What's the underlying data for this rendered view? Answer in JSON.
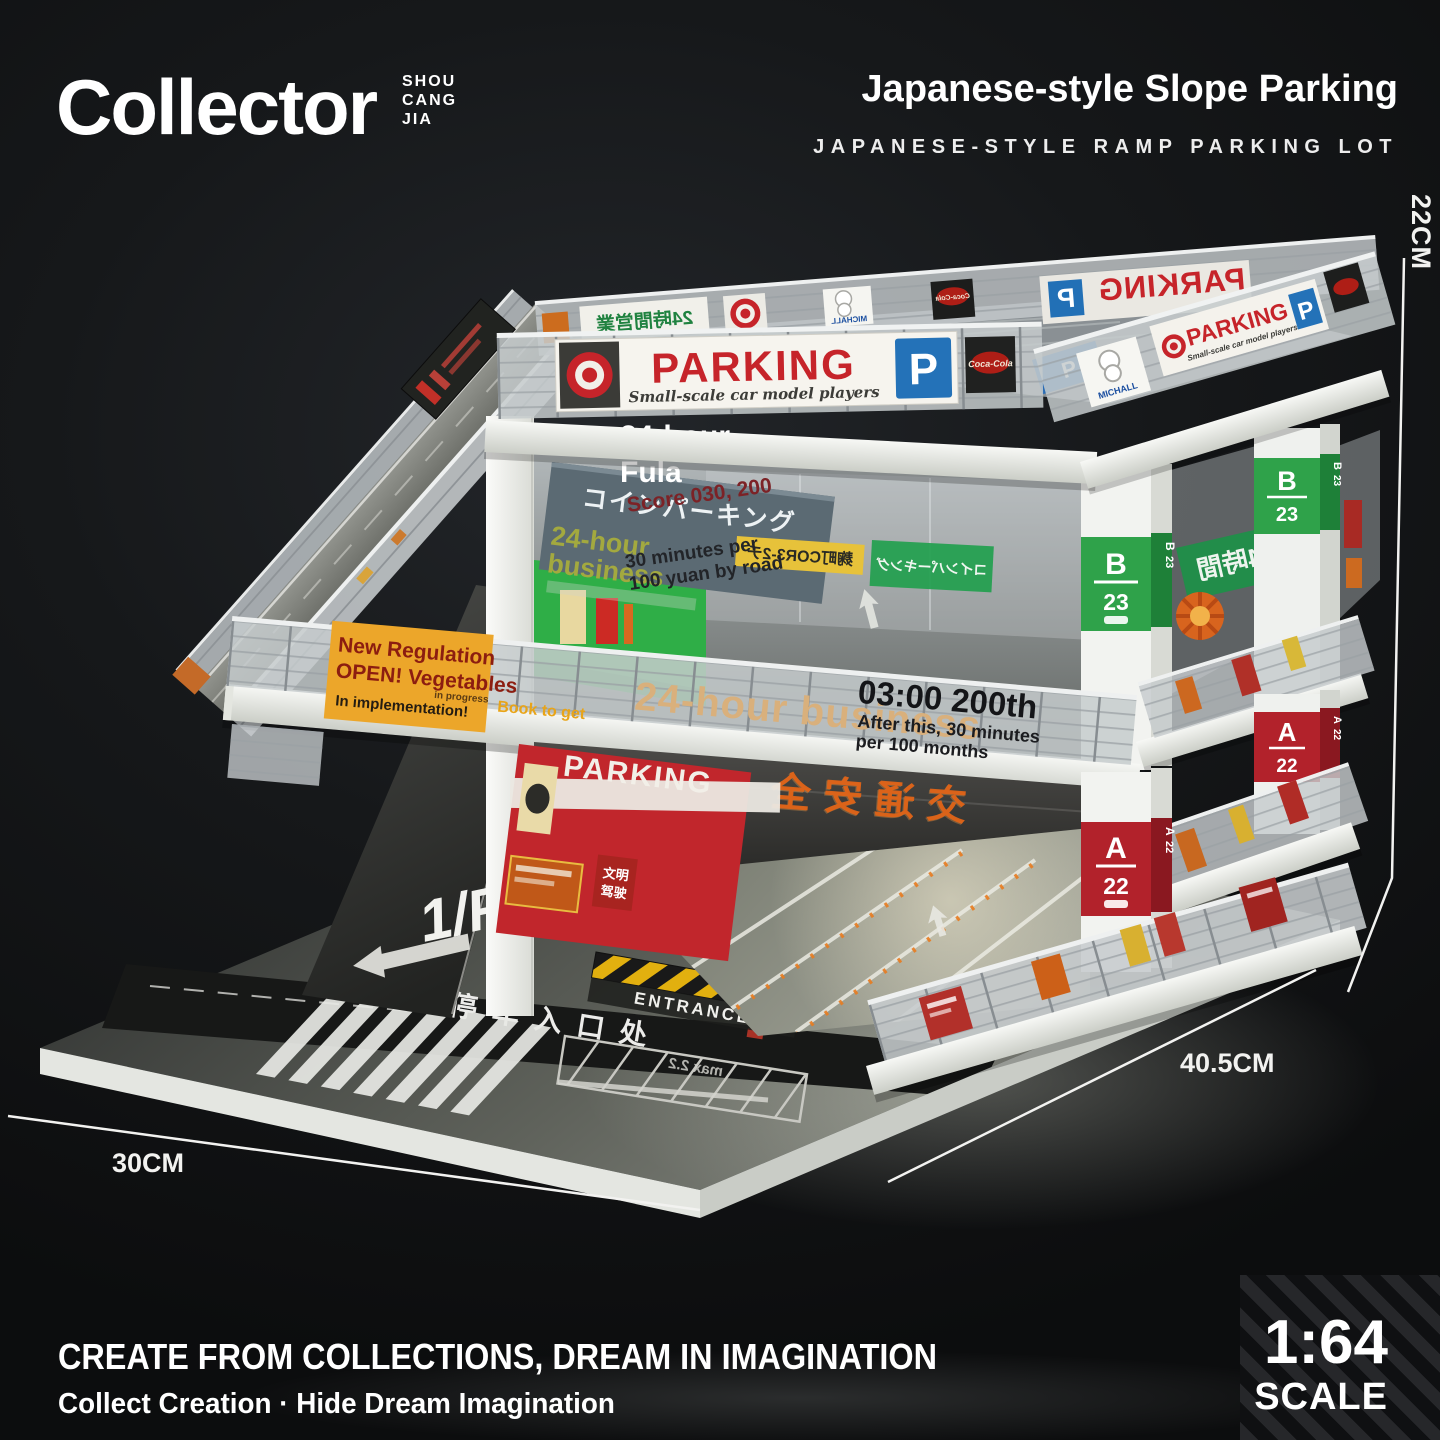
{
  "header": {
    "brand": "Collector",
    "brand_sub_lines": [
      "SHOU",
      "CANG",
      "JIA"
    ],
    "title": "Japanese-style Slope Parking",
    "subtitle": "JAPANESE-STYLE RAMP PARKING LOT"
  },
  "dimensions": {
    "height": "22CM",
    "width": "30CM",
    "depth": "40.5CM"
  },
  "footer": {
    "tagline_en": "CREATE FROM COLLECTIONS, DREAM IN IMAGINATION",
    "tagline_sub": "Collect Creation · Hide Dream Imagination",
    "scale_ratio": "1:64",
    "scale_label": "SCALE"
  },
  "model": {
    "roof": {
      "parking_sign": {
        "title": "PARKING",
        "subtitle": "Small-scale car model players",
        "p": "P"
      },
      "jp_24h_sign": "24時間営業",
      "michelin_label": "MICHALL",
      "cola_label": "Coca-Cola",
      "bay_p": "P"
    },
    "floor2": {
      "coin_parking_jp": "コインパーキング",
      "business_line1": "24-hour",
      "business_line2": "business",
      "overlay_line1": "24-hour",
      "overlay_line2": "Fula",
      "overlay_score": "Score 030, 200",
      "overlay_rate1": "30 minutes per",
      "overlay_rate2": "100 yuan by road",
      "yellow_sign_jp": "麹町COR3-2チ",
      "glass_24h_jp": "24時間",
      "pillar_letter": "B",
      "pillar_number": "23"
    },
    "midband": {
      "notice_line1": "New Regulation",
      "notice_line2": "OPEN! Vegetables",
      "notice_line3": "In implementation!",
      "notice_line4": "in progress",
      "notice_line5": "Book to get",
      "business_overlay": "24-hour business",
      "time_bold": "03:00 200th",
      "time_sub1": "After this, 30 minutes",
      "time_sub2": "per 100 months"
    },
    "floor1": {
      "red_wall_text": "PARKING",
      "led_text": "交通安全",
      "small_sign_line1": "文明",
      "small_sign_line2": "驾驶",
      "pillar_letter": "A",
      "pillar_number": "22",
      "ramp_2f": "2/F",
      "ramp_1f": "1/F",
      "entrance": "ENTRANCE",
      "keep_line1": "IN",
      "keep_line2": "KEEP",
      "keep_line3": "RIGHT",
      "entrance_zh": "停车入口处",
      "road_mirror_text": "max 2.2"
    }
  }
}
